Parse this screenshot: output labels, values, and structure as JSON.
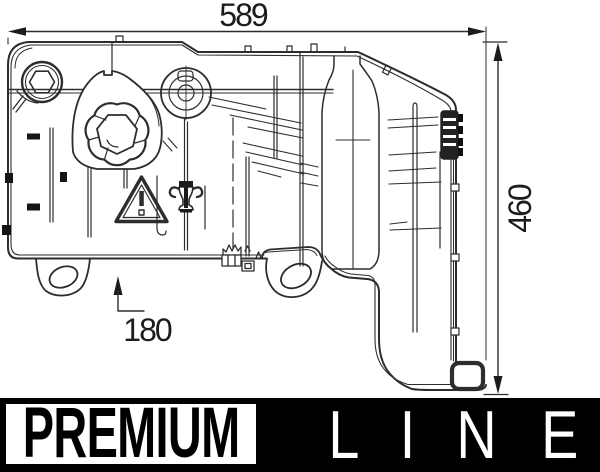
{
  "drawing": {
    "kind": "technical-line-drawing",
    "line_color": "#2d2d2d",
    "background": "#ffffff"
  },
  "dimensions": {
    "width": {
      "label": "589"
    },
    "height": {
      "label": "460"
    },
    "offset": {
      "label": "180"
    }
  },
  "branding": {
    "premium_label": "PREMIUM",
    "line_letters": [
      "L",
      "I",
      "N",
      "E"
    ],
    "premium_text_color": "#000000",
    "premium_bg": "#ffffff",
    "line_text_color": "#ffffff",
    "line_bg": "#000000"
  }
}
